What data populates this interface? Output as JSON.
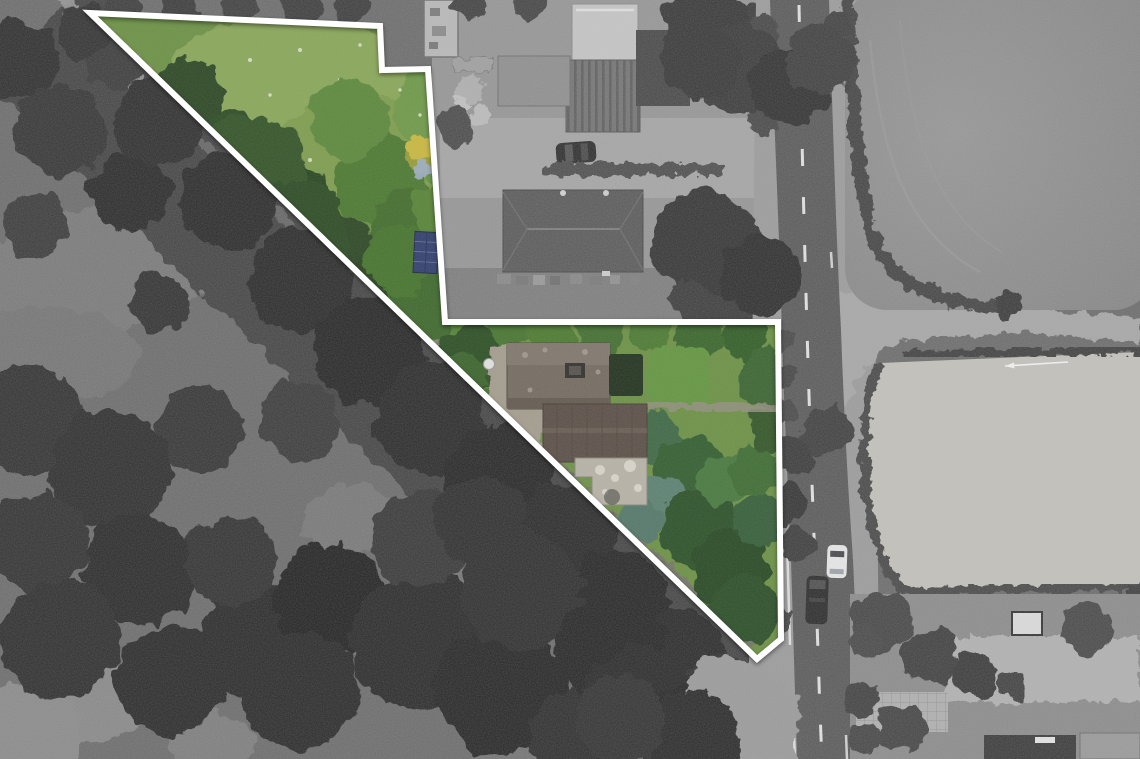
{
  "meta": {
    "kind": "aerial-drone-photograph",
    "subject": "building plot highlighted in colour on a greyscale aerial photo",
    "width_px": 1140,
    "height_px": 759
  },
  "boundary": {
    "svg_points": "90,13 380,26 382,70 428,69 445,322 778,322 781,639 757,659",
    "stroke_color": "#ffffff",
    "stroke_width": 6
  },
  "palette": {
    "scrub_grey": "#6c6c6c",
    "canopy_dark_grey": "#2c2c2c",
    "field_top_right": "#8f8f8f",
    "field_bottom_right": "#c4c2bb",
    "road_asphalt": "#5a5a5a",
    "road_marking": "#efefef",
    "verge_grey": "#9c9c9c",
    "plot_base_green": "#6d9246",
    "plot_meadow_green": "#8aa85a",
    "plot_tree_dark_green": "#2d4a26",
    "house_roof_upper": "#756c62",
    "house_roof_lower": "#5c5149",
    "house_flat_roof": "#b7b3a8",
    "shed_blue": "#33406e",
    "yellow_tree": "#c9b93f",
    "white_car": "#e9e9e9",
    "dark_van": "#2b2b2b",
    "parked_car": "#2e2e2e"
  },
  "scene": {
    "vehicles": [
      {
        "name": "white-car",
        "lane": "northbound"
      },
      {
        "name": "dark-van",
        "lane": "southbound"
      },
      {
        "name": "parked-dark-car",
        "location": "farm courtyard"
      }
    ],
    "road": {
      "orientation": "vertical",
      "marking_style": "dashed centerline"
    }
  }
}
